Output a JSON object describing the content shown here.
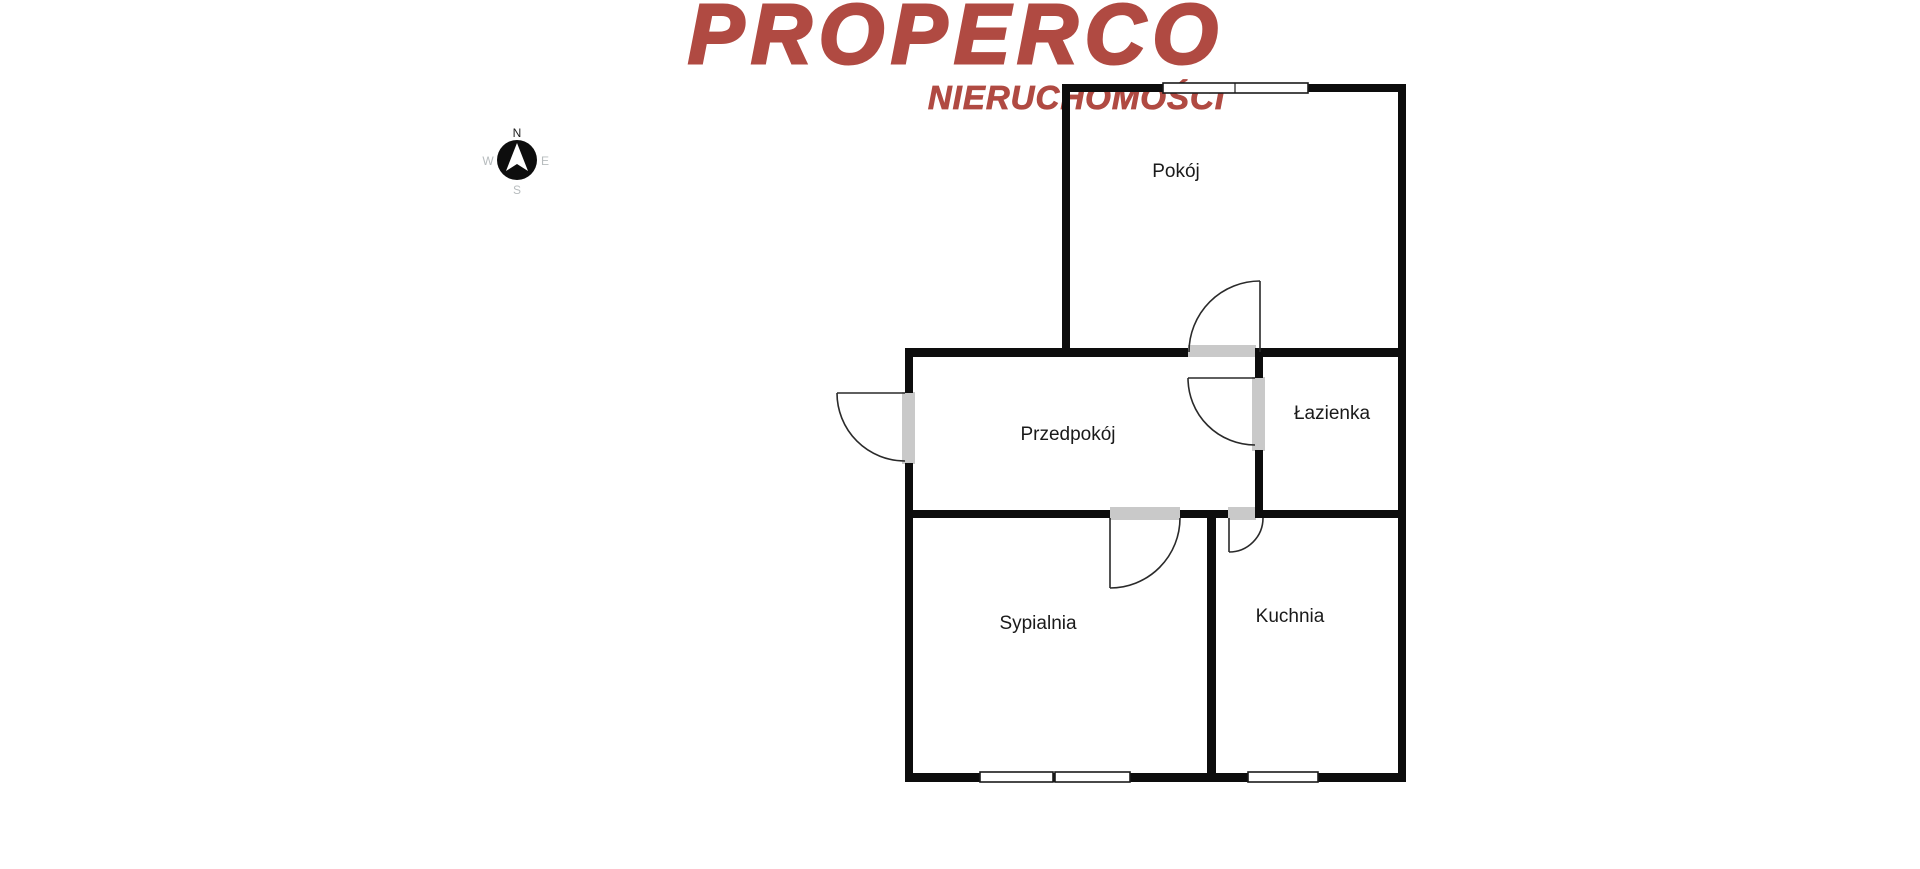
{
  "logo": {
    "brand": "PROPERCO",
    "subtitle": "NIERUCHOMOŚCI"
  },
  "compass": {
    "north": "N",
    "east": "E",
    "south": "S",
    "west": "W"
  },
  "floor_plan": {
    "rooms": [
      {
        "id": "pokoj",
        "label": "Pokój"
      },
      {
        "id": "przedpokoj",
        "label": "Przedpokój"
      },
      {
        "id": "lazienka",
        "label": "Łazienka"
      },
      {
        "id": "sypialnia",
        "label": "Sypialnia"
      },
      {
        "id": "kuchnia",
        "label": "Kuchnia"
      }
    ]
  },
  "colors": {
    "brand_red": "#b04a42",
    "wall_black": "#0d0d0d",
    "door_opening_gray": "#c9c9c9",
    "label_text": "#1a1a1a",
    "compass_north": "#1f1f1f",
    "compass_secondary": "#b7bcbe"
  }
}
